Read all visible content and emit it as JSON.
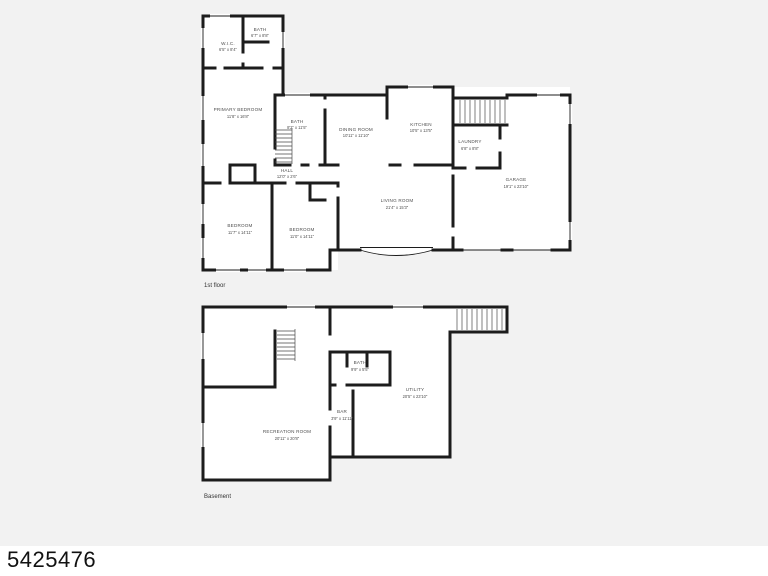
{
  "colors": {
    "canvas_bg": "#f2f2f2",
    "room_fill": "#ffffff",
    "wall": "#1c1c1c",
    "label": "#4e4e4e",
    "footer_bg": "#ffffff",
    "footer_text": "#111111"
  },
  "footer": {
    "mls_number": "5425476"
  },
  "floors": [
    {
      "name": "1st floor",
      "rooms": [
        {
          "id": "wic",
          "label": "W.I.C.",
          "dims": "6'5\" x 8'4\""
        },
        {
          "id": "bath-top",
          "label": "BATH",
          "dims": "6'7\" x 8'8\""
        },
        {
          "id": "primary-bedroom",
          "label": "PRIMARY BEDROOM",
          "dims": "11'8\" x 16'8\""
        },
        {
          "id": "bath-hall",
          "label": "BATH",
          "dims": "8'2\" x 11'5\""
        },
        {
          "id": "hall",
          "label": "HALL",
          "dims": "12'0\" x 2'6\""
        },
        {
          "id": "bedroom-left",
          "label": "BEDROOM",
          "dims": "11'7\" x 14'11\""
        },
        {
          "id": "bedroom-right",
          "label": "BEDROOM",
          "dims": "11'0\" x 14'11\""
        },
        {
          "id": "dining-room",
          "label": "DINING ROOM",
          "dims": "10'11\" x 11'10\""
        },
        {
          "id": "kitchen",
          "label": "KITCHEN",
          "dims": "10'5\" x 13'5\""
        },
        {
          "id": "laundry",
          "label": "LAUNDRY",
          "dims": "6'8\" x 8'8\""
        },
        {
          "id": "living-room",
          "label": "LIVING ROOM",
          "dims": "21'4\" x 15'3\""
        },
        {
          "id": "garage",
          "label": "GARAGE",
          "dims": "19'1\" x 23'10\""
        }
      ]
    },
    {
      "name": "Basement",
      "rooms": [
        {
          "id": "bath-basement",
          "label": "BATH",
          "dims": "9'9\" x 5'5\""
        },
        {
          "id": "utility",
          "label": "UTILITY",
          "dims": "20'5\" x 23'10\""
        },
        {
          "id": "bar",
          "label": "BAR",
          "dims": "3'9\" x 11'11\""
        },
        {
          "id": "recreation-room",
          "label": "RECREATION ROOM",
          "dims": "20'11\" x 20'8\""
        }
      ]
    }
  ]
}
